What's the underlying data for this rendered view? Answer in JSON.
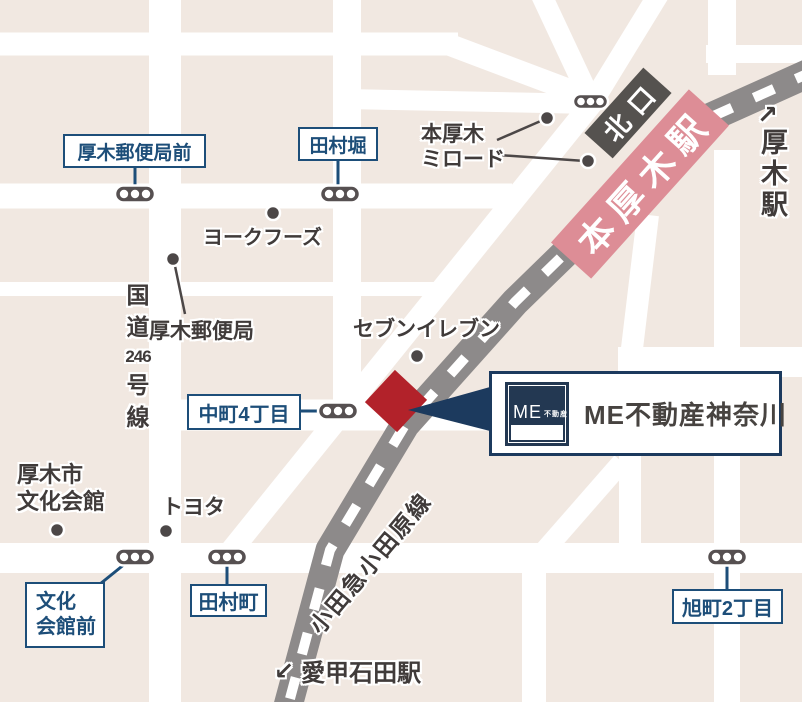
{
  "stations": {
    "hon_atsugi": "本厚木駅",
    "north_exit": "北口",
    "atsugi": {
      "arrow": "↗",
      "name": "厚木駅"
    },
    "aiko_ishida": {
      "arrow": "↙",
      "name": "愛甲石田駅"
    }
  },
  "railway": {
    "name": "小田急小田原線"
  },
  "roads": {
    "route246": {
      "chars": [
        "国",
        "道",
        "246",
        "号",
        "線"
      ]
    }
  },
  "bus_stops": {
    "atsugi_yubinkyoku_mae": "厚木郵便局前",
    "tamurabori": "田村堀",
    "nakacho_4chome": "中町4丁目",
    "bunka_kaikan_mae": {
      "line1": "文化",
      "line2": "会館前"
    },
    "tamuracho": "田村町",
    "asahicho_2chome": "旭町2丁目"
  },
  "pois": {
    "york_foods": "ヨークフーズ",
    "atsugi_post_office": "厚木郵便局",
    "seven_eleven": "セブンイレブン",
    "hon_atsugi_mylord": {
      "line1": "本厚木",
      "line2": "ミロード"
    },
    "atsugi_shi_bunka_kaikan": {
      "line1": "厚木市",
      "line2": "文化会館"
    },
    "toyota": "トヨタ"
  },
  "callout": {
    "logo": {
      "me": "ME",
      "fudosan": "不動産"
    },
    "label": "ME不動産神奈川"
  },
  "colors": {
    "background": "#f1e8e1",
    "street": "#ffffff",
    "railway_gray": "#8d8a8a",
    "station_pink": "#dd8d96",
    "north_exit_gray": "#55524f",
    "marker_red": "#b2222a",
    "navy": "#1d4e79",
    "callout_navy": "#1c3a5e",
    "logo_navy": "#233852",
    "text_dark": "#403b3a"
  }
}
